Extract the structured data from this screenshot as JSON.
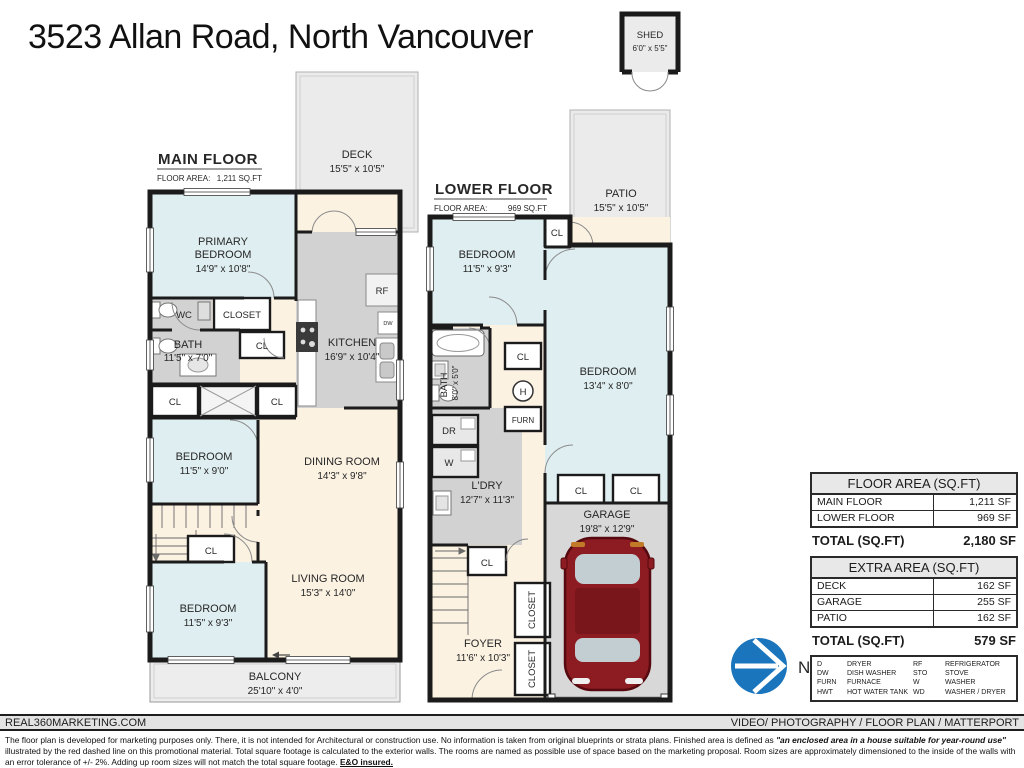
{
  "page": {
    "title": "3523 Allan Road, North Vancouver"
  },
  "shed": {
    "name": "SHED",
    "dims": "6'0\" x 5'5\""
  },
  "main_floor": {
    "title": "MAIN FLOOR",
    "area_label": "FLOOR AREA:",
    "area_value": "1,211 SQ.FT",
    "deck": {
      "name": "DECK",
      "dims": "15'5\" x 10'5\""
    },
    "primary_bedroom": {
      "line1": "PRIMARY",
      "line2": "BEDROOM",
      "dims": "14'9\" x 10'8\""
    },
    "wc": "WC",
    "closet": "CLOSET",
    "bath": {
      "name": "BATH",
      "dims": "11'5\" x 7'0\""
    },
    "cl": "CL",
    "bedroom2": {
      "name": "BEDROOM",
      "dims": "11'5\" x 9'0\""
    },
    "kitchen": {
      "name": "KITCHEN",
      "dims": "16'9\" x 10'4\""
    },
    "rf": "RF",
    "dw": "DW",
    "dining": {
      "name": "DINING ROOM",
      "dims": "14'3\" x 9'8\""
    },
    "bedroom3": {
      "name": "BEDROOM",
      "dims": "11'5\" x 9'3\""
    },
    "living": {
      "name": "LIVING ROOM",
      "dims": "15'3\" x 14'0\""
    },
    "balcony": {
      "name": "BALCONY",
      "dims": "25'10\" x 4'0\""
    }
  },
  "lower_floor": {
    "title": "LOWER FLOOR",
    "area_label": "FLOOR AREA:",
    "area_value": "969 SQ.FT",
    "patio": {
      "name": "PATIO",
      "dims": "15'5\" x 10'5\""
    },
    "bedroom1": {
      "name": "BEDROOM",
      "dims": "11'5\" x 9'3\""
    },
    "cl": "CL",
    "bedroom2": {
      "name": "BEDROOM",
      "dims": "13'4\" x 8'0\""
    },
    "bath": {
      "name": "BATH",
      "dims": "8'0\" x 5'0\""
    },
    "h": "H",
    "furn": "FURN",
    "dr": "DR",
    "w": "W",
    "ldry": {
      "name": "L'DRY",
      "dims": "12'7\" x 11'3\""
    },
    "garage": {
      "name": "GARAGE",
      "dims": "19'8\" x 12'9\""
    },
    "foyer": {
      "name": "FOYER",
      "dims": "11'6\" x 10'3\""
    },
    "closet": "CLOSET"
  },
  "floor_area_table": {
    "header": "FLOOR AREA (SQ.FT)",
    "rows": [
      {
        "label": "MAIN FLOOR",
        "value": "1,211 SF"
      },
      {
        "label": "LOWER FLOOR",
        "value": "969 SF"
      }
    ],
    "total_label": "TOTAL (SQ.FT)",
    "total_value": "2,180 SF"
  },
  "extra_area_table": {
    "header": "EXTRA AREA (SQ.FT)",
    "rows": [
      {
        "label": "DECK",
        "value": "162 SF"
      },
      {
        "label": "GARAGE",
        "value": "255 SF"
      },
      {
        "label": "PATIO",
        "value": "162 SF"
      }
    ],
    "total_label": "TOTAL (SQ.FT)",
    "total_value": "579 SF"
  },
  "legend": {
    "items": [
      {
        "abbr": "D",
        "label": "DRYER"
      },
      {
        "abbr": "DW",
        "label": "DISH WASHER"
      },
      {
        "abbr": "FURN",
        "label": "FURNACE"
      },
      {
        "abbr": "HWT",
        "label": "HOT WATER TANK"
      },
      {
        "abbr": "RF",
        "label": "REFRIGERATOR"
      },
      {
        "abbr": "STO",
        "label": "STOVE"
      },
      {
        "abbr": "W",
        "label": "WASHER"
      },
      {
        "abbr": "WD",
        "label": "WASHER / DRYER"
      }
    ]
  },
  "compass": {
    "label": "N"
  },
  "footer": {
    "left": "REAL360MARKETING.COM",
    "right": "VIDEO/ PHOTOGRAPHY / FLOOR PLAN / MATTERPORT",
    "disclaimer_1": "The floor plan is developed for marketing purposes only. There, it is not intended for Architectural or construction use. No information is  taken from original blueprints or strata plans. Finished area is defined as ",
    "disclaimer_italic": "\"an enclosed area in a house suitable for year-round use\"",
    "disclaimer_2": " illustrated by the red dashed line on this promotional material. Total square footage is calculated to the exterior walls. The rooms are named as possible use of space based on the marketing proposal. Room sizes are approximately dimensioned to the inside of the walls with an error tolerance of +/- 2%. Adding up room sizes will not match the total square footage. ",
    "disclaimer_bold": "E&O insured."
  },
  "colors": {
    "accent_red": "#9c2b35",
    "compass_blue": "#1b75bc",
    "car_red": "#8c1c22",
    "bedroom_blue": "#dfeef1",
    "cream": "#fbf2e2",
    "room_gray": "#d2d2d2",
    "outdoor_gray": "#ebebeb",
    "wall_black": "#1b1b1b"
  }
}
